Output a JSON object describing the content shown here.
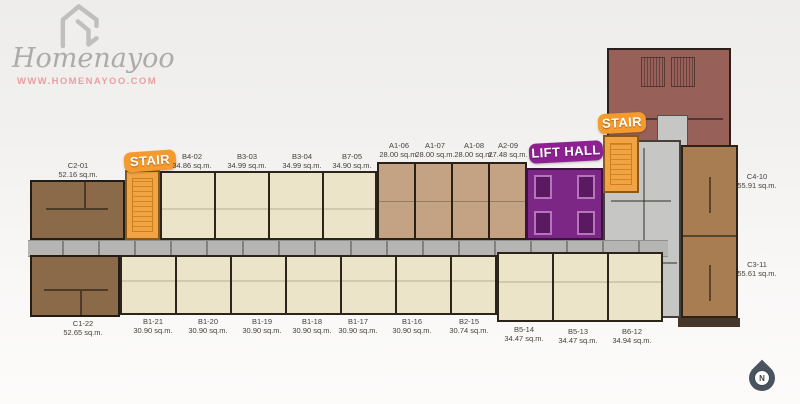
{
  "logo": {
    "brand": "Homenayoo",
    "url": "WWW.HOMENAYOO.COM",
    "icon": "house-logo-icon"
  },
  "badges": {
    "stair_left": "STAIR",
    "stair_right": "STAIR",
    "lift_hall": "LIFT HALL"
  },
  "compass": {
    "label": "N"
  },
  "units": {
    "top": [
      {
        "id": "C2-01",
        "area": "52.16 sq.m."
      },
      {
        "id": "B4-02",
        "area": "34.86 sq.m."
      },
      {
        "id": "B3-03",
        "area": "34.99 sq.m."
      },
      {
        "id": "B3-04",
        "area": "34.99 sq.m."
      },
      {
        "id": "B7-05",
        "area": "34.90 sq.m."
      },
      {
        "id": "A1-06",
        "area": "28.00 sq.m."
      },
      {
        "id": "A1-07",
        "area": "28.00 sq.m."
      },
      {
        "id": "A1-08",
        "area": "28.00 sq.m."
      },
      {
        "id": "A2-09",
        "area": "27.48 sq.m."
      }
    ],
    "right": [
      {
        "id": "C4-10",
        "area": "55.91 sq.m."
      },
      {
        "id": "C3-11",
        "area": "55.61 sq.m."
      }
    ],
    "bottom": [
      {
        "id": "C1-22",
        "area": "52.65 sq.m."
      },
      {
        "id": "B1-21",
        "area": "30.90 sq.m."
      },
      {
        "id": "B1-20",
        "area": "30.90 sq.m."
      },
      {
        "id": "B1-19",
        "area": "30.90 sq.m."
      },
      {
        "id": "B1-18",
        "area": "30.90 sq.m."
      },
      {
        "id": "B1-17",
        "area": "30.90 sq.m."
      },
      {
        "id": "B1-16",
        "area": "30.90 sq.m."
      },
      {
        "id": "B2-15",
        "area": "30.74 sq.m."
      },
      {
        "id": "B5-14",
        "area": "34.47 sq.m."
      },
      {
        "id": "B5-13",
        "area": "34.47 sq.m."
      },
      {
        "id": "B6-12",
        "area": "34.94 sq.m."
      }
    ]
  },
  "colors": {
    "badge_orange": "#F59B2D",
    "badge_purple": "#8D2191",
    "stair_fill": "#F2A343",
    "lift_fill": "#7C2785",
    "unit_cream": "#ECE4C8",
    "unit_tan": "#C4A284",
    "unit_brown": "#8B6A49",
    "unit_brown_right": "#A87D52",
    "wing_brown": "#976059",
    "corridor_gray": "#B5B6B4",
    "url_pink": "#E8A0A3",
    "compass_slate": "#4A545E"
  }
}
